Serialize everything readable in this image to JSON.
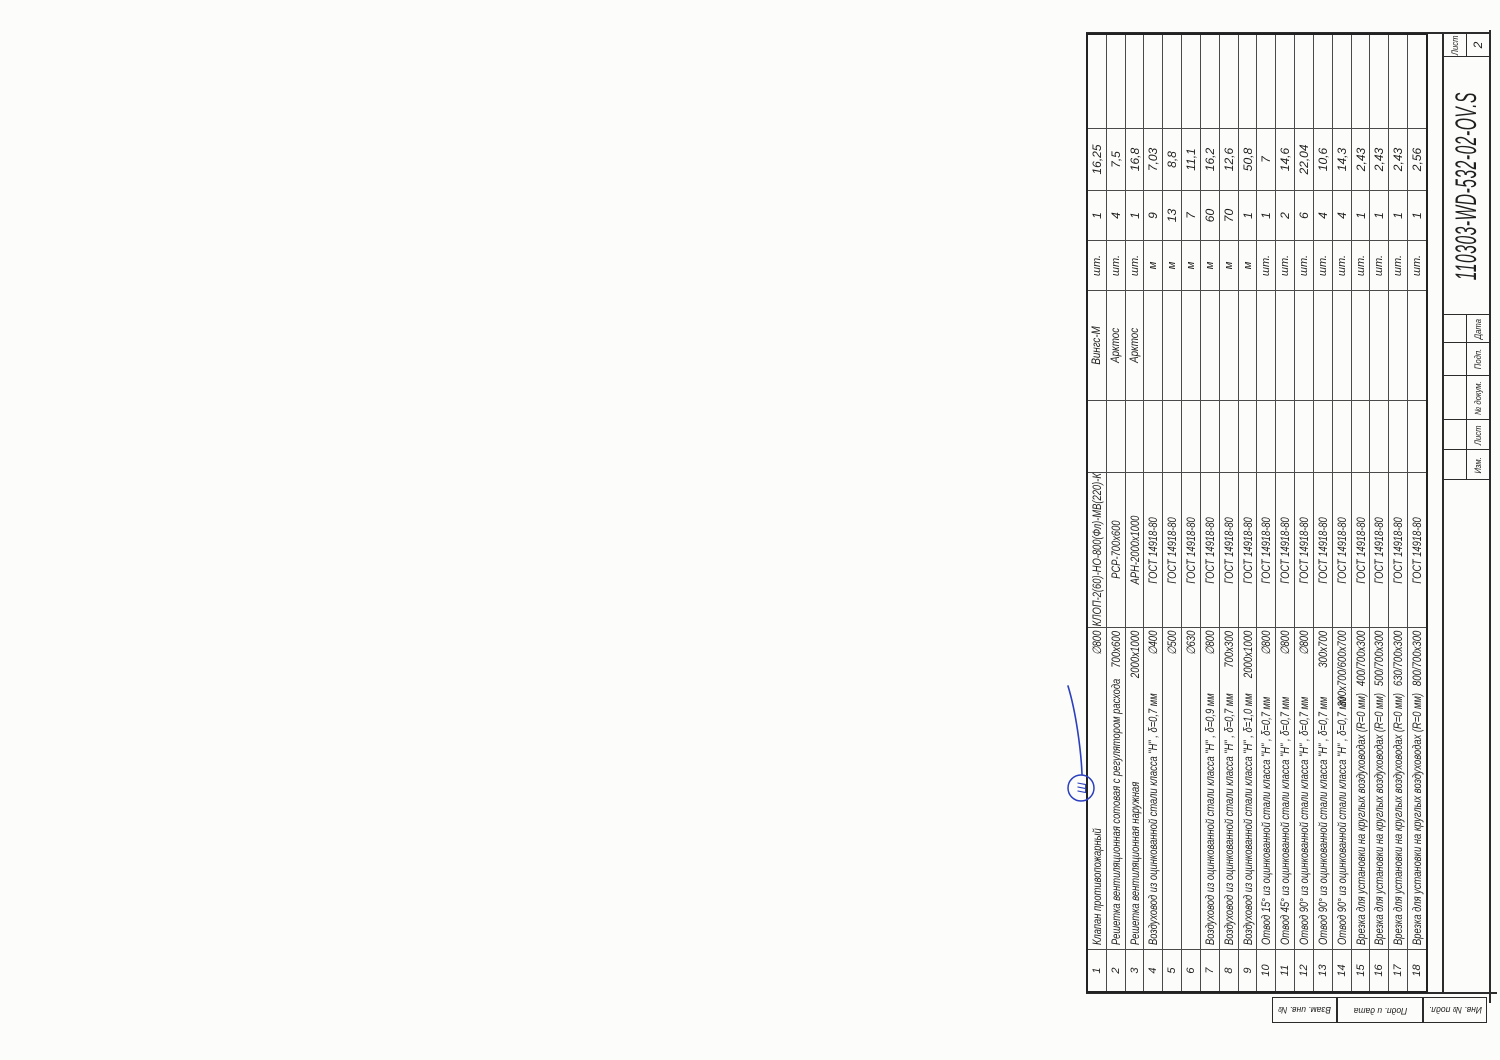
{
  "page": {
    "doc_number": "110303-WD-532-02-OV.S",
    "sheet_label": "Лист",
    "sheet_number": "2",
    "revision_labels": [
      "Изм.",
      "Лист",
      "№ докум.",
      "Подп.",
      "Дата"
    ],
    "margin_stamps": [
      "Взам. инв. №",
      "Подп. и дата",
      "Инв. № подл."
    ],
    "handwritten_mark": "Ш",
    "colors": {
      "ink": "#2c2c2c",
      "pen_blue": "#2b3fbf",
      "corner_mark": "#8b2322"
    }
  },
  "spec_table": {
    "type": "table",
    "rows": [
      {
        "pos": "1",
        "name": "Клапан противопожарный",
        "size": "∅800",
        "designation": "КЛОП-2(60)-НО-800(Фл)-МВ(220)-К",
        "manufacturer": "Вингс-М",
        "unit": "шт.",
        "qty": "1",
        "mass": "16,25"
      },
      {
        "pos": "2",
        "name": "Решетка вентиляционная сотовая с регулятором расхода",
        "size": "700х600",
        "designation": "РСР-700х600",
        "manufacturer": "Арктос",
        "unit": "шт.",
        "qty": "4",
        "mass": "7,5"
      },
      {
        "pos": "3",
        "name": "Решетка вентиляционная наружная",
        "size": "2000х1000",
        "designation": "АРН-2000х1000",
        "manufacturer": "Арктос",
        "unit": "шт.",
        "qty": "1",
        "mass": "16,8"
      },
      {
        "pos": "4",
        "name": "Воздуховод  из оцинкованной стали класса \"Н\" , δ=0,7 мм",
        "size": "∅400",
        "designation": "ГОСТ 14918-80",
        "manufacturer": "",
        "unit": "м",
        "qty": "9",
        "mass": "7,03"
      },
      {
        "pos": "5",
        "name": "",
        "size": "∅500",
        "designation": "ГОСТ 14918-80",
        "manufacturer": "",
        "unit": "м",
        "qty": "13",
        "mass": "8,8"
      },
      {
        "pos": "6",
        "name": "",
        "size": "∅630",
        "designation": "ГОСТ 14918-80",
        "manufacturer": "",
        "unit": "м",
        "qty": "7",
        "mass": "11,1"
      },
      {
        "pos": "7",
        "name": "Воздуховод  из оцинкованной стали класса \"Н\" , δ=0,9 мм",
        "size": "∅800",
        "designation": "ГОСТ 14918-80",
        "manufacturer": "",
        "unit": "м",
        "qty": "60",
        "mass": "16,2"
      },
      {
        "pos": "8",
        "name": "Воздуховод  из оцинкованной стали класса \"Н\" , δ=0,7 мм",
        "size": "700х300",
        "designation": "ГОСТ 14918-80",
        "manufacturer": "",
        "unit": "м",
        "qty": "70",
        "mass": "12,6"
      },
      {
        "pos": "9",
        "name": "Воздуховод  из оцинкованной стали класса \"Н\" , δ=1,0 мм",
        "size": "2000х1000",
        "designation": "ГОСТ 14918-80",
        "manufacturer": "",
        "unit": "м",
        "qty": "1",
        "mass": "50,8"
      },
      {
        "pos": "10",
        "name": "Отвод 15° из оцинкованной стали класса \"Н\" , δ=0,7 мм",
        "size": "∅800",
        "designation": "ГОСТ 14918-80",
        "manufacturer": "",
        "unit": "шт.",
        "qty": "1",
        "mass": "7"
      },
      {
        "pos": "11",
        "name": "Отвод 45° из оцинкованной стали класса \"Н\" , δ=0,7 мм",
        "size": "∅800",
        "designation": "ГОСТ 14918-80",
        "manufacturer": "",
        "unit": "шт.",
        "qty": "2",
        "mass": "14,6"
      },
      {
        "pos": "12",
        "name": "Отвод 90° из оцинкованной стали класса \"Н\" , δ=0,7 мм",
        "size": "∅800",
        "designation": "ГОСТ 14918-80",
        "manufacturer": "",
        "unit": "шт.",
        "qty": "6",
        "mass": "22,04"
      },
      {
        "pos": "13",
        "name": "Отвод 90° из оцинкованной стали класса \"Н\" , δ=0,7 мм",
        "size": "300х700",
        "designation": "ГОСТ 14918-80",
        "manufacturer": "",
        "unit": "шт.",
        "qty": "4",
        "mass": "10,6"
      },
      {
        "pos": "14",
        "name": "Отвод 90° из оцинкованной стали класса \"Н\" , δ=0,7 мм",
        "size": "300х700/600х700",
        "designation": "ГОСТ 14918-80",
        "manufacturer": "",
        "unit": "шт.",
        "qty": "4",
        "mass": "14,3"
      },
      {
        "pos": "15",
        "name": "Врезка для установки на круглых воздуховодах  (R=0 мм)",
        "size": "400/700х300",
        "designation": "ГОСТ 14918-80",
        "manufacturer": "",
        "unit": "шт.",
        "qty": "1",
        "mass": "2,43"
      },
      {
        "pos": "16",
        "name": "Врезка для установки на круглых воздуховодах  (R=0 мм)",
        "size": "500/700х300",
        "designation": "ГОСТ 14918-80",
        "manufacturer": "",
        "unit": "шт.",
        "qty": "1",
        "mass": "2,43"
      },
      {
        "pos": "17",
        "name": "Врезка для установки на круглых воздуховодах  (R=0 мм)",
        "size": "630/700х300",
        "designation": "ГОСТ 14918-80",
        "manufacturer": "",
        "unit": "шт.",
        "qty": "1",
        "mass": "2,43"
      },
      {
        "pos": "18",
        "name": "Врезка для установки на круглых воздуховодах  (R=0 мм)",
        "size": "800/700х300",
        "designation": "ГОСТ 14918-80",
        "manufacturer": "",
        "unit": "шт.",
        "qty": "1",
        "mass": "2,56"
      }
    ]
  }
}
